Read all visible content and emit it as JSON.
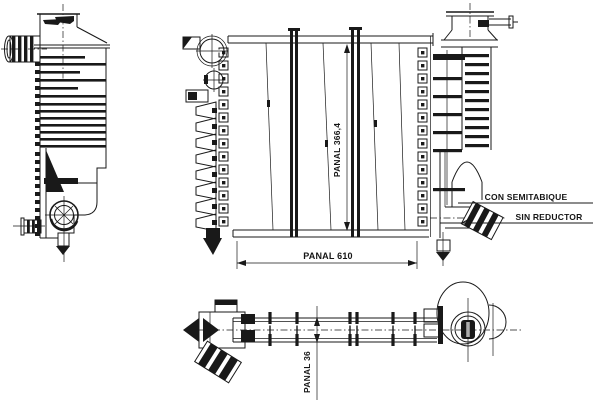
{
  "drawing": {
    "colors": {
      "ink": "#191919",
      "paper": "#ffffff"
    },
    "dimensions": {
      "panel_height_label": "PANAL 366,4",
      "panel_width_label": "PANAL 610",
      "panel_depth_label": "PANAL 36"
    },
    "notes": {
      "semipartition": "CON SEMITABIQUE",
      "no_reducer": "SIN REDUCTOR"
    }
  }
}
